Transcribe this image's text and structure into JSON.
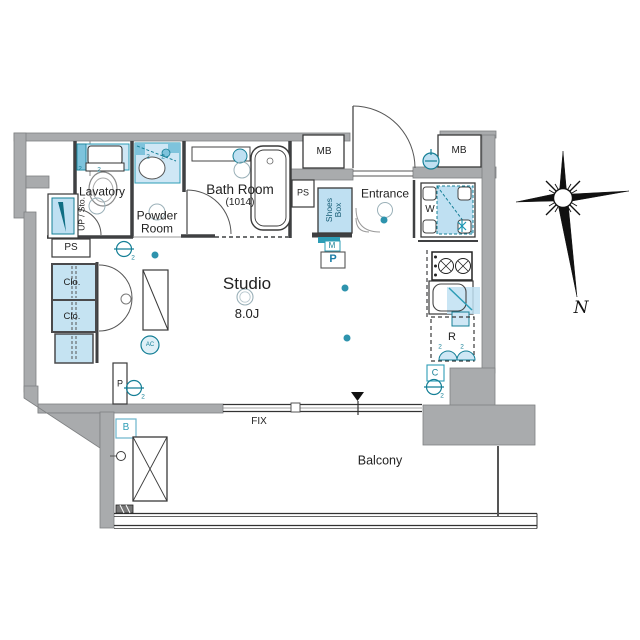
{
  "floorplan": {
    "rooms": {
      "lavatory": "Lavatory",
      "up_storage": "UP / Sto.",
      "powder_room": "Powder Room",
      "bath_room": "Bath Room",
      "bath_room_size": "(1014)",
      "shoes_box": "Shoes Box",
      "entrance": "Entrance",
      "studio": "Studio",
      "studio_size": "8.0J",
      "balcony": "Balcony"
    },
    "labels": {
      "mb_left": "MB",
      "mb_right": "MB",
      "ps_upper": "PS",
      "ps_lower": "PS",
      "closet_upper": "Clo.",
      "closet_lower": "Clo.",
      "washing_machine": "W",
      "refrigerator": "R",
      "counter": "C",
      "meter": "M",
      "pillar_hall": "P",
      "pillar_balcony": "P",
      "balcony_hatch": "B",
      "fix_window": "FIX",
      "air_conditioner": "AC",
      "compass_north": "N"
    },
    "annotations": {
      "downlight_count": "2"
    },
    "colors": {
      "wall_gray": "#a9abad",
      "fixture_blue": "#cfe7f5",
      "accent_teal": "#157f96",
      "line_dark": "#3a3a3a"
    }
  }
}
